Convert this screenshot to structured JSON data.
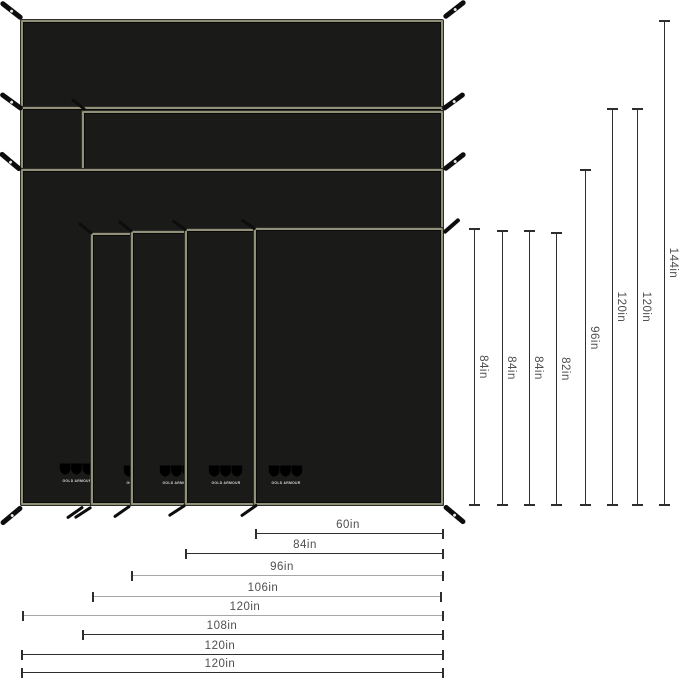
{
  "brand": {
    "logo_text": "GOLD ARMOUR"
  },
  "dimensions": {
    "vertical": [
      "84in",
      "84in",
      "84in",
      "82in",
      "96in",
      "120in",
      "120in",
      "144in"
    ],
    "horizontal": [
      "60in",
      "84in",
      "96in",
      "106in",
      "120in",
      "108in",
      "120in",
      "120in"
    ]
  },
  "colors": {
    "background": "#ffffff",
    "tarp_fill": "#1a1a18",
    "tarp_border": "#90907b",
    "dimension_dark": "#2e2e2e",
    "dimension_gray": "#a6a6a6",
    "label_text": "#4f4f4f",
    "strap": "#0d0d0d",
    "logo": "#d8d8d8"
  }
}
